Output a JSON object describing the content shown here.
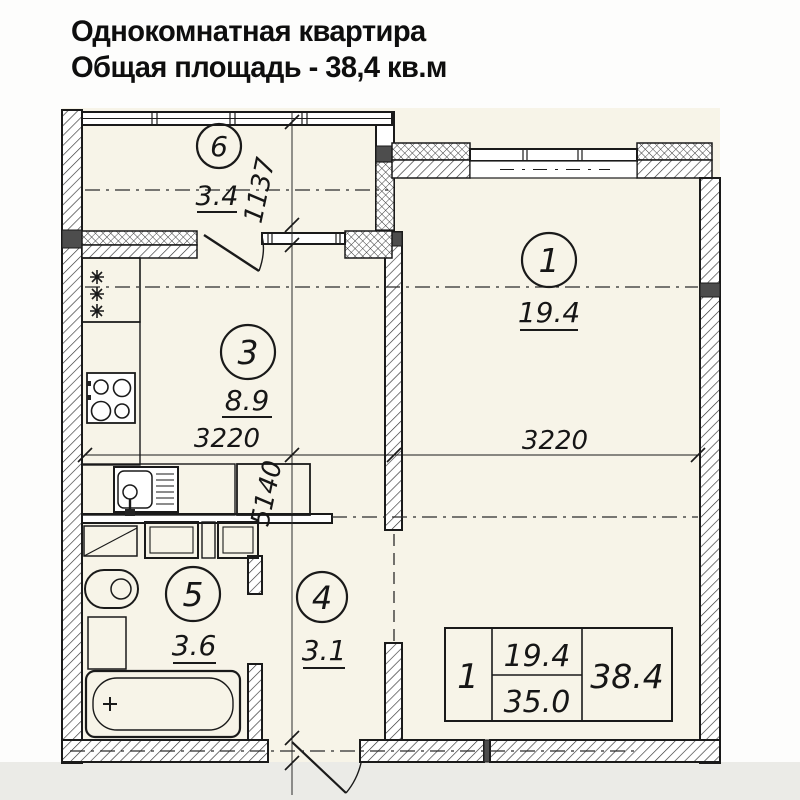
{
  "title": {
    "line1": "Однокомнатная квартира",
    "line2": "Общая площадь - 38,4 кв.м"
  },
  "rooms": {
    "living": {
      "number": "1",
      "area": "19.4"
    },
    "kitchen": {
      "number": "3",
      "area": "8.9"
    },
    "hallway": {
      "number": "4",
      "area": "3.1"
    },
    "bathroom": {
      "number": "5",
      "area": "3.6"
    },
    "balcony": {
      "number": "6",
      "area": "3.4"
    }
  },
  "dimensions": {
    "balcony_depth": "1137",
    "kitchen_width": "3220",
    "living_width": "3220",
    "apartment_depth": "5140"
  },
  "summary_table": {
    "rooms_count": "1",
    "living_area": "19.4",
    "area_without_balcony": "35.0",
    "total_area": "38.4"
  },
  "colors": {
    "plan_background": "#f7f4e8",
    "line": "#1a1a1a",
    "dark_fill": "#4d4d4d",
    "footer_band": "#ebebe7"
  }
}
